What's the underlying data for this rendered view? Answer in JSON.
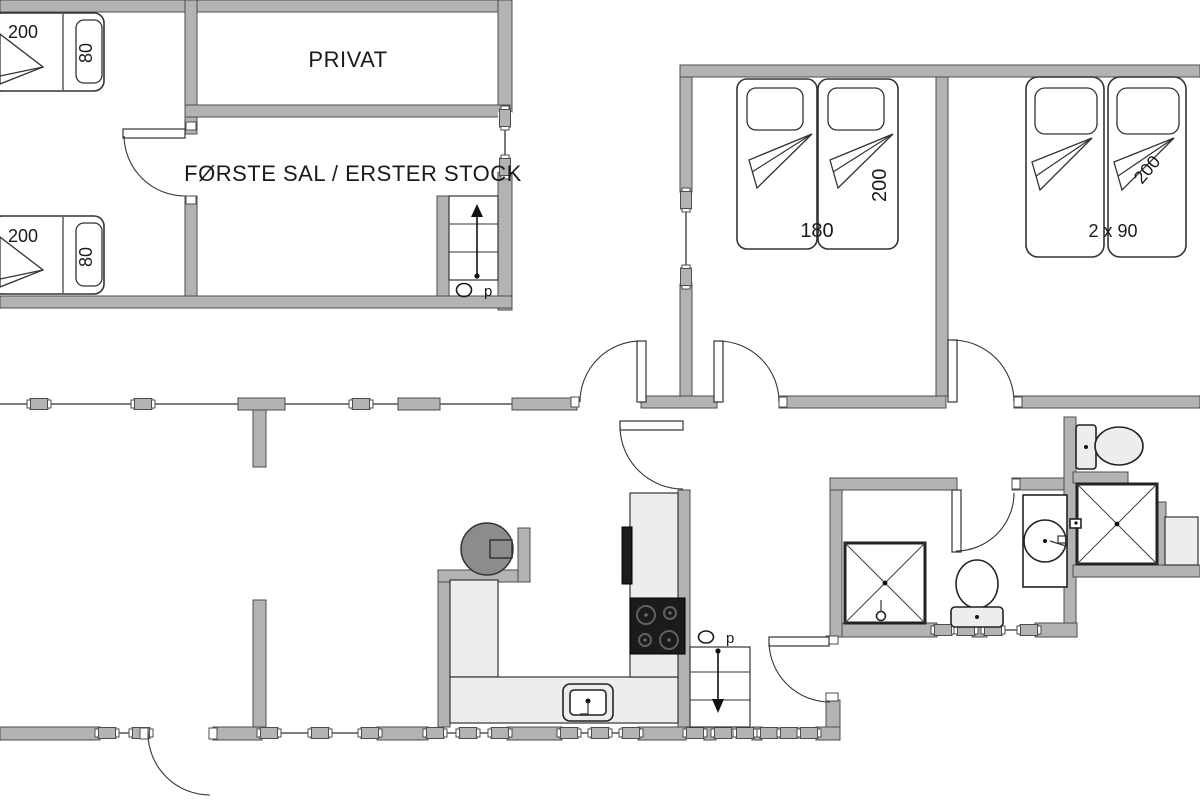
{
  "colors": {
    "wall_fill": "#b3b3b3",
    "wall_stroke": "#4d4d4d",
    "line": "#333333",
    "counter_fill": "#ededed",
    "cooktop": "#1b1b1b",
    "wood_stove": "#8c8c8c",
    "background": "#ffffff"
  },
  "upper_floor": {
    "room_private": "PRIVAT",
    "room_label": "FØRSTE SAL / ERSTER STOCK",
    "bed_top": {
      "length": "200",
      "width": "80"
    },
    "bed_bottom": {
      "length": "200",
      "width": "80"
    },
    "stairs": {
      "direction": "p"
    }
  },
  "ground_floor": {
    "bedroom_double": {
      "width": "180",
      "length": "200"
    },
    "bedroom_twins": {
      "size": "2 x 90",
      "length": "200"
    },
    "stairs": {
      "direction": "p"
    }
  }
}
